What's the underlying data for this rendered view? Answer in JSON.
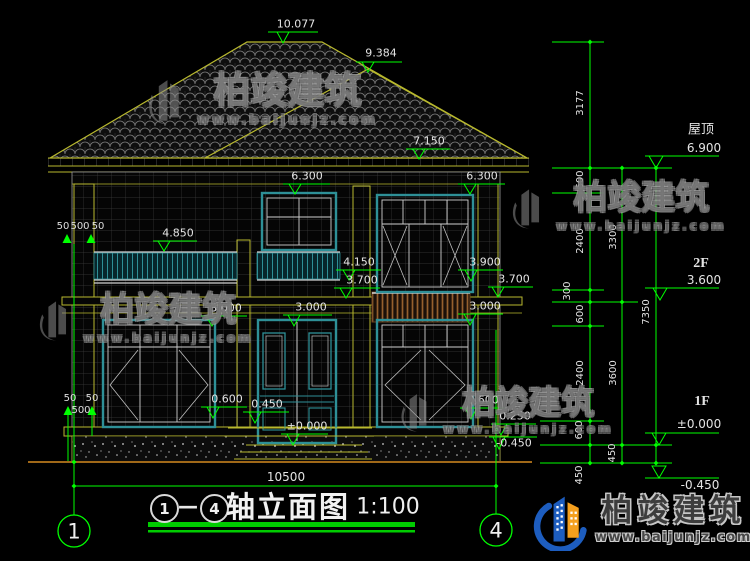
{
  "levels": {
    "peak_main": "10.077",
    "peak_secondary": "9.384",
    "roof_secondary_eave": "7.150",
    "win2f_head_left": "6.300",
    "win2f_head_right": "6.300",
    "balcony_rail": "4.850",
    "small_rail": "4.150",
    "slab_bottom_left": "3.700",
    "win2f_sill_right": "3.900",
    "slab_bottom_right": "3.700",
    "win1f_head_left": "3.000",
    "door_head": "3.000",
    "win1f_head_right": "3.000",
    "win1f_sill_left": "0.600",
    "porch": "0.450",
    "floor_1f": "±0.000",
    "win1f_sill_right": "0.600",
    "plinth": "0.250",
    "ground": "-0.450"
  },
  "overall_width": "10500",
  "pier_dims": {
    "t1": "50",
    "t2": "500",
    "t3": "50",
    "b1": "50",
    "b2": "50",
    "b3": "500"
  },
  "dim_chains": {
    "c1": [
      "3177",
      "600",
      "2400",
      "300",
      "600",
      "2400",
      "600",
      "450"
    ],
    "c2": [
      "3300",
      "3600",
      "450"
    ],
    "c3": [
      "7350"
    ]
  },
  "side_levels": [
    {
      "name": "屋顶",
      "value": "6.900"
    },
    {
      "name": "2F",
      "value": "3.600"
    },
    {
      "name": "1F",
      "value": "±0.000"
    },
    {
      "name": "",
      "value": "-0.450"
    }
  ],
  "axis_bubbles": {
    "left": "1",
    "right": "4"
  },
  "caption": {
    "from": "1",
    "to": "4",
    "dash": "—",
    "title": "轴立面图",
    "scale": "1:100"
  },
  "brand": {
    "name": "柏竣建筑",
    "site": "www.baijunjz.com"
  },
  "colors": {
    "dim_green": "#00ff00",
    "line_yellow": "#b9b92e",
    "frame_teal": "#2e9097",
    "railing_brown": "#96602e",
    "ground_brown": "#a06818",
    "logo_blue": "#1d5dbf",
    "logo_orange": "#f5a01e"
  }
}
